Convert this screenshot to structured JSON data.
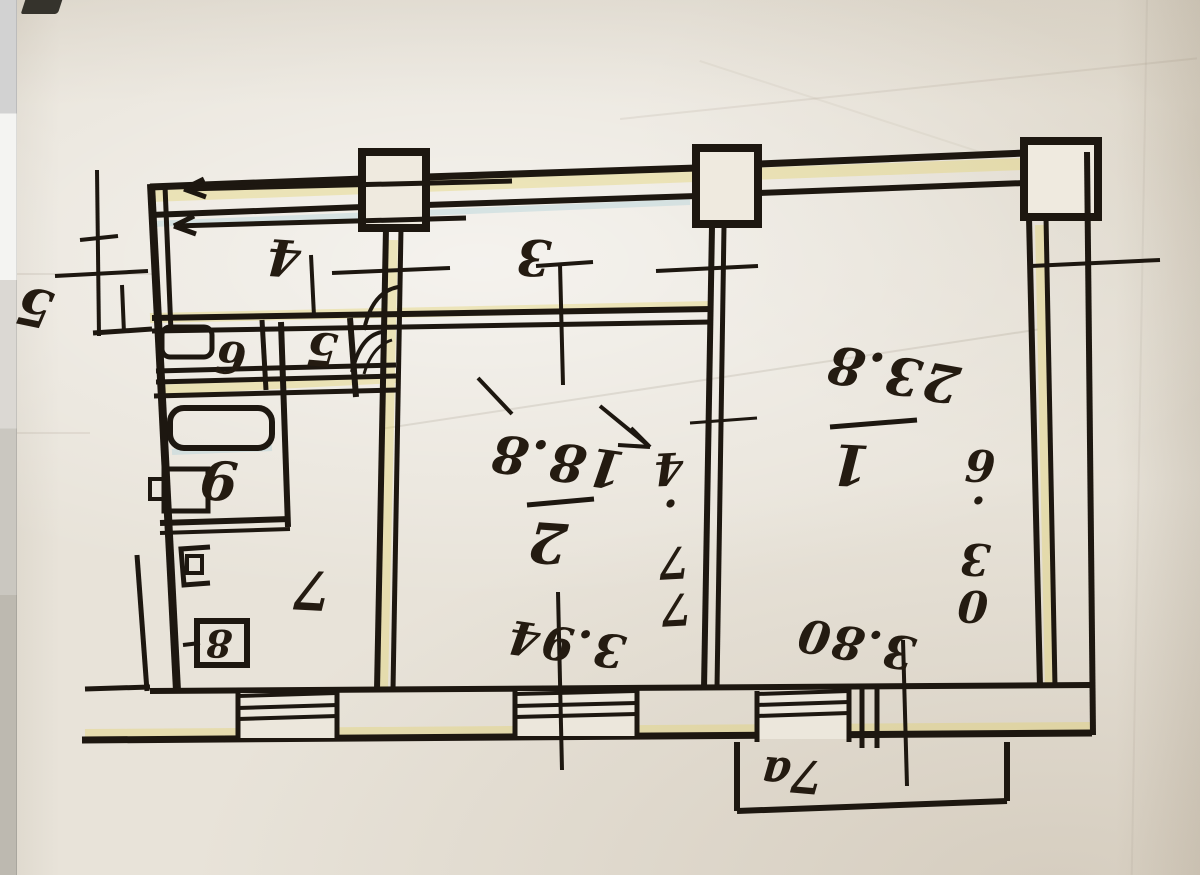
{
  "plan": {
    "rooms": {
      "room1": {
        "number": "1",
        "area": "23.8"
      },
      "room2": {
        "number": "2",
        "area": "18.8"
      },
      "corridor": {
        "number": "3"
      },
      "hallway": {
        "number": "4"
      },
      "wc": {
        "number": "5"
      },
      "washroom": {
        "number": "6"
      },
      "kitchen": {
        "number": "7"
      },
      "closet": {
        "number": "8"
      },
      "bathroom": {
        "number": "9"
      },
      "balcony": {
        "number": "7a"
      },
      "staircase": {
        "number": "5"
      }
    },
    "dimensions": {
      "room1_width": "3.80",
      "room1_depth": "6.30",
      "room2_width": "3.94",
      "room2_depth": "4.77"
    }
  },
  "colors": {
    "ink": "#1d1710",
    "paper": "#e8e3d9",
    "fringe_yellow": "#e3d36a",
    "fringe_blue": "#b9d6dc",
    "edge_strip": "#d2d2d2"
  }
}
